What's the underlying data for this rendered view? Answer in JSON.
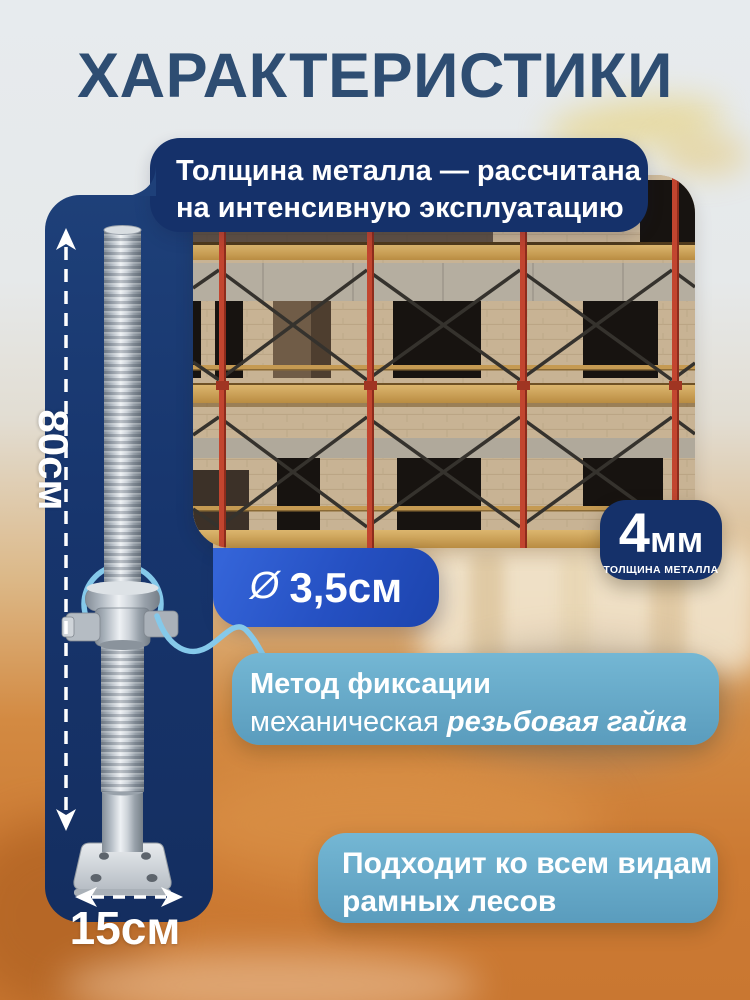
{
  "title": "ХАРАКТЕРИСТИКИ",
  "callouts": {
    "thickness_note": {
      "line1": "Толщина металла — рассчитана",
      "line2": "на интенсивную эксплуатацию"
    },
    "diameter": {
      "symbol": "Ø",
      "value": "3,5см"
    },
    "thickness_badge": {
      "value": "4",
      "unit": "мм",
      "caption": "ТОЛЩИНА МЕТАЛЛА"
    },
    "fixation": {
      "line1": "Метод фиксации",
      "line2_prefix": "механическая ",
      "line2_emphasis": "резьбовая гайка"
    },
    "compatibility": {
      "line1": "Подходит ко всем видам",
      "line2": "рамных лесов"
    }
  },
  "dimensions": {
    "height": "80см",
    "base_width": "15см"
  },
  "colors": {
    "title_navy": "#2e4d72",
    "panel_navy": "#17356d",
    "accent_blue": "#2550c2",
    "steel_blue": "#65a6c6",
    "sky_blue": "#85c9ea",
    "background_orange": "#cc7a33",
    "scaffold_red": "#c2452f",
    "plank_wood": "#c59a52"
  }
}
